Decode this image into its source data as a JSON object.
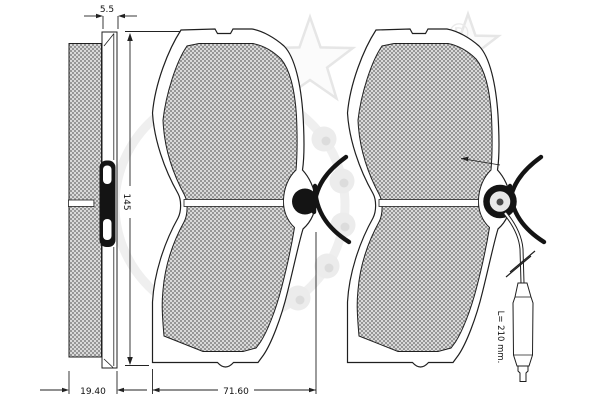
{
  "drawing": {
    "subject": "disc-brake-pad-set-technical-drawing",
    "dimensions": {
      "plate_thickness": "5.5",
      "pad_height": "145",
      "assembly_thickness": "19.40",
      "pad_width": "71.60",
      "sensor_wire_length": "L= 210 mm."
    },
    "watermark": {
      "registered": "®"
    },
    "colors": {
      "line": "#1f1f1f",
      "dimension_line": "#222222",
      "friction_dark": "#969696",
      "friction_light": "#d9d9d9",
      "watermark_gray": "#ececec",
      "background": "#ffffff"
    }
  }
}
